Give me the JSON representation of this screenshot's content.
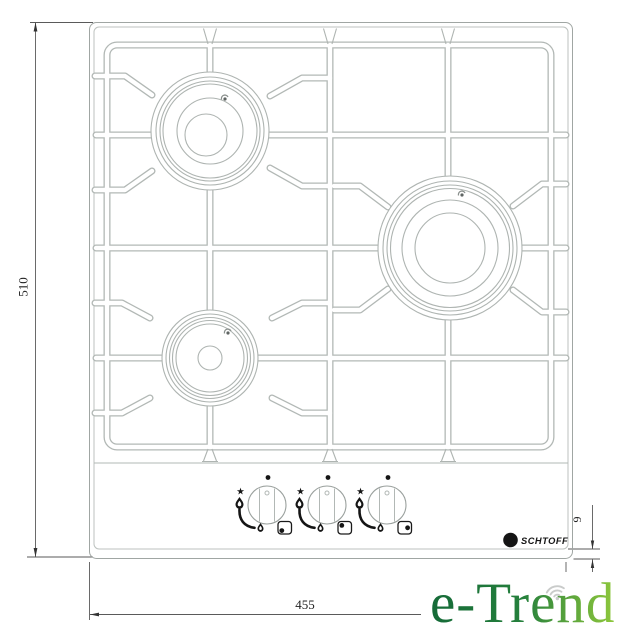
{
  "canvas": {
    "width": 631,
    "height": 640,
    "background": "#ffffff"
  },
  "drawing": {
    "description": "gas hob top-view installation drawing with three burners and three control knobs",
    "line_color": "#b2b8b5",
    "dim_color": "#2a2a2a"
  },
  "dimensions": {
    "depth_mm": "510",
    "width_mm": "455",
    "edge_mm": "9"
  },
  "brand": {
    "logo_letter": "S",
    "name": "SCHTOFF",
    "color": "#141414"
  },
  "knobs": {
    "count": 3,
    "star_glyph": "★"
  },
  "watermark": {
    "text": "e-Trend",
    "green_dark": "#156a38",
    "green_mid": "#25803c",
    "green_light": "#8fc83c",
    "wifi_color": "#c9cbca"
  }
}
